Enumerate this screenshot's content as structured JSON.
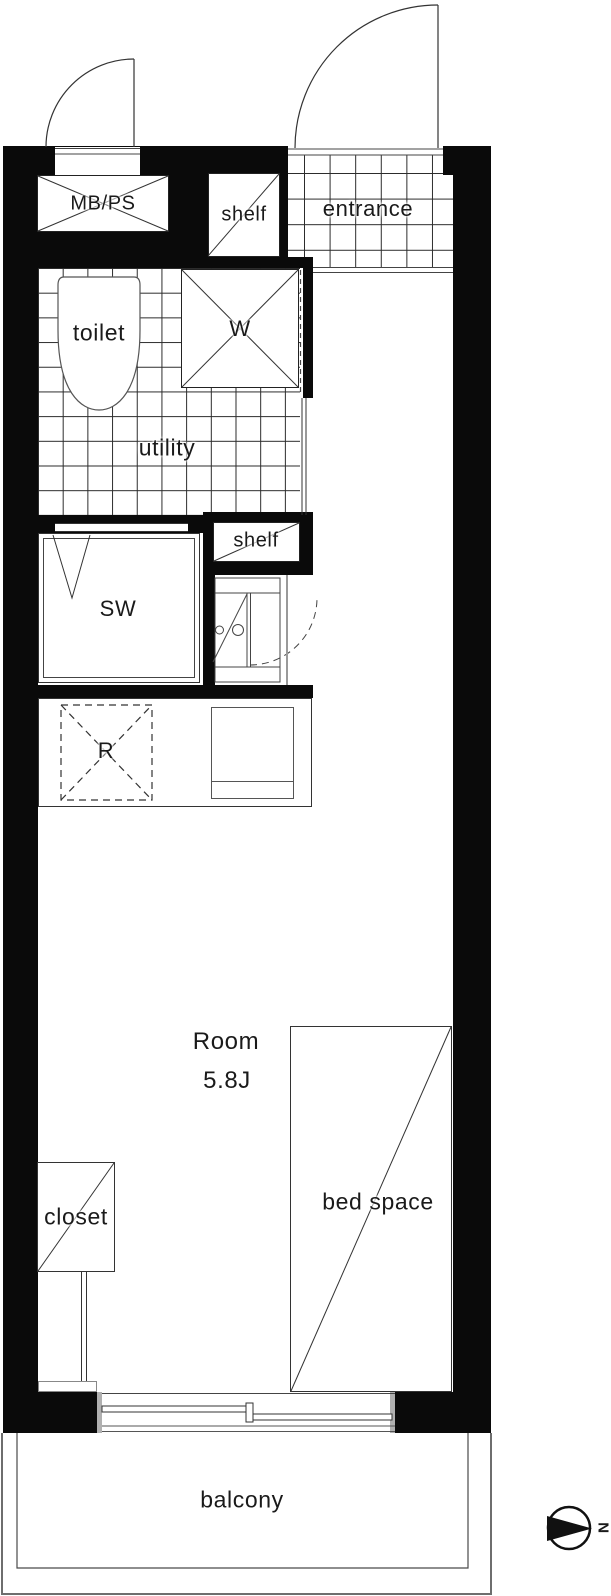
{
  "document": {
    "type": "apartment-floor-plan",
    "unit_size_label": "5.8J"
  },
  "colors": {
    "wall": "#0a0a0a",
    "line": "#333333",
    "text": "#1a1a1a",
    "muted": "#999999"
  },
  "labels": {
    "mbps": "MB/PS",
    "shelf_top": "shelf",
    "entrance": "entrance",
    "toilet": "toilet",
    "washer": "W",
    "utility": "utility",
    "shelf_mid": "shelf",
    "shower_room": "SW",
    "refrigerator": "R",
    "room_name": "Room",
    "room_size": "5.8J",
    "bed_space": "bed space",
    "closet": "closet",
    "balcony": "balcony",
    "north": "N"
  }
}
